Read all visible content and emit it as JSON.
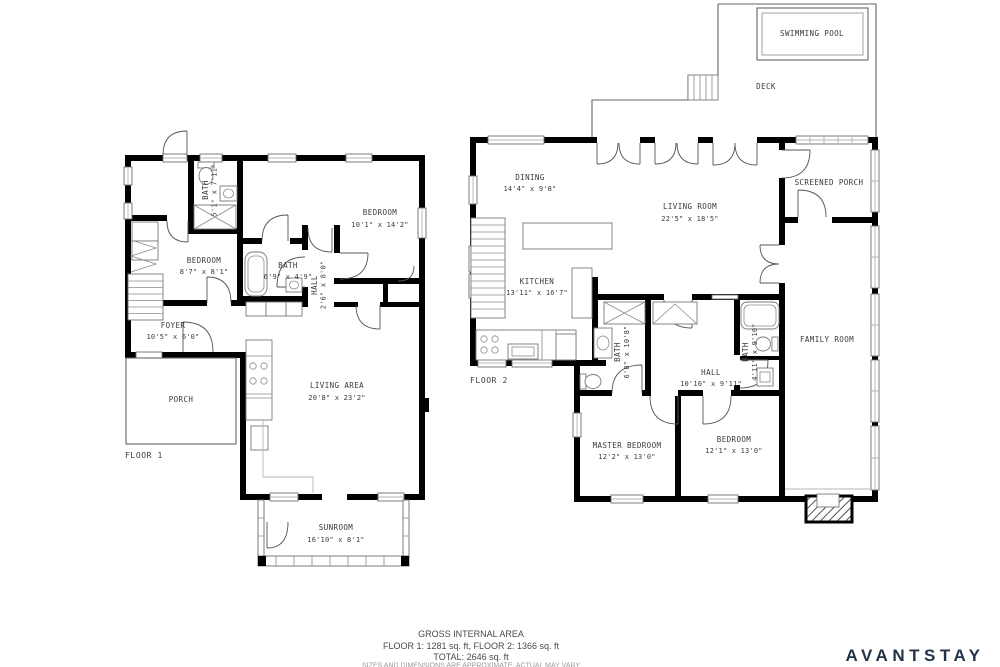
{
  "floor1": {
    "label": "FLOOR 1",
    "rooms": {
      "bath_upper": {
        "name": "BATH",
        "dims": "5'1\" x 7'11\""
      },
      "bedroom_left": {
        "name": "BEDROOM",
        "dims": "8'7\" x 8'1\""
      },
      "bedroom_right": {
        "name": "BEDROOM",
        "dims": "10'1\" x 14'2\""
      },
      "bath_mid": {
        "name": "BATH",
        "dims": "6'9\" x 4'9\""
      },
      "hall": {
        "name": "HALL",
        "dims": "2'6\" x 8'0\""
      },
      "foyer": {
        "name": "FOYER",
        "dims": "10'5\" x 6'0\""
      },
      "porch": {
        "name": "PORCH"
      },
      "living_area": {
        "name": "LIVING AREA",
        "dims": "20'8\" x 23'2\""
      },
      "sunroom": {
        "name": "SUNROOM",
        "dims": "16'10\" x 8'1\""
      }
    }
  },
  "floor2": {
    "label": "FLOOR 2",
    "rooms": {
      "swimming_pool": {
        "name": "SWIMMING POOL"
      },
      "deck": {
        "name": "DECK"
      },
      "dining": {
        "name": "DINING",
        "dims": "14'4\" x 9'8\""
      },
      "living_room": {
        "name": "LIVING ROOM",
        "dims": "22'5\" x 18'5\""
      },
      "kitchen": {
        "name": "KITCHEN",
        "dims": "13'11\" x 16'7\""
      },
      "screened_porch": {
        "name": "SCREENED PORCH"
      },
      "family_room": {
        "name": "FAMILY ROOM"
      },
      "bath_master": {
        "name": "BATH",
        "dims": "6'0\" x 10'8\""
      },
      "bath_second": {
        "name": "BATH",
        "dims": "4'11\" x 9'10\""
      },
      "hall": {
        "name": "HALL",
        "dims": "10'10\" x 9'11\""
      },
      "master_bedroom": {
        "name": "MASTER BEDROOM",
        "dims": "12'2\" x 13'0\""
      },
      "bedroom": {
        "name": "BEDROOM",
        "dims": "12'1\" x 13'0\""
      }
    }
  },
  "footer": {
    "title": "GROSS INTERNAL AREA",
    "floors": "FLOOR 1: 1281 sq. ft, FLOOR 2: 1366 sq. ft",
    "total": "TOTAL: 2646 sq. ft",
    "disclaimer": "SIZES AND DIMENSIONS ARE APPROXIMATE, ACTUAL MAY VARY"
  },
  "brand": {
    "name": "AVANTSTAY",
    "color": "#233349"
  }
}
